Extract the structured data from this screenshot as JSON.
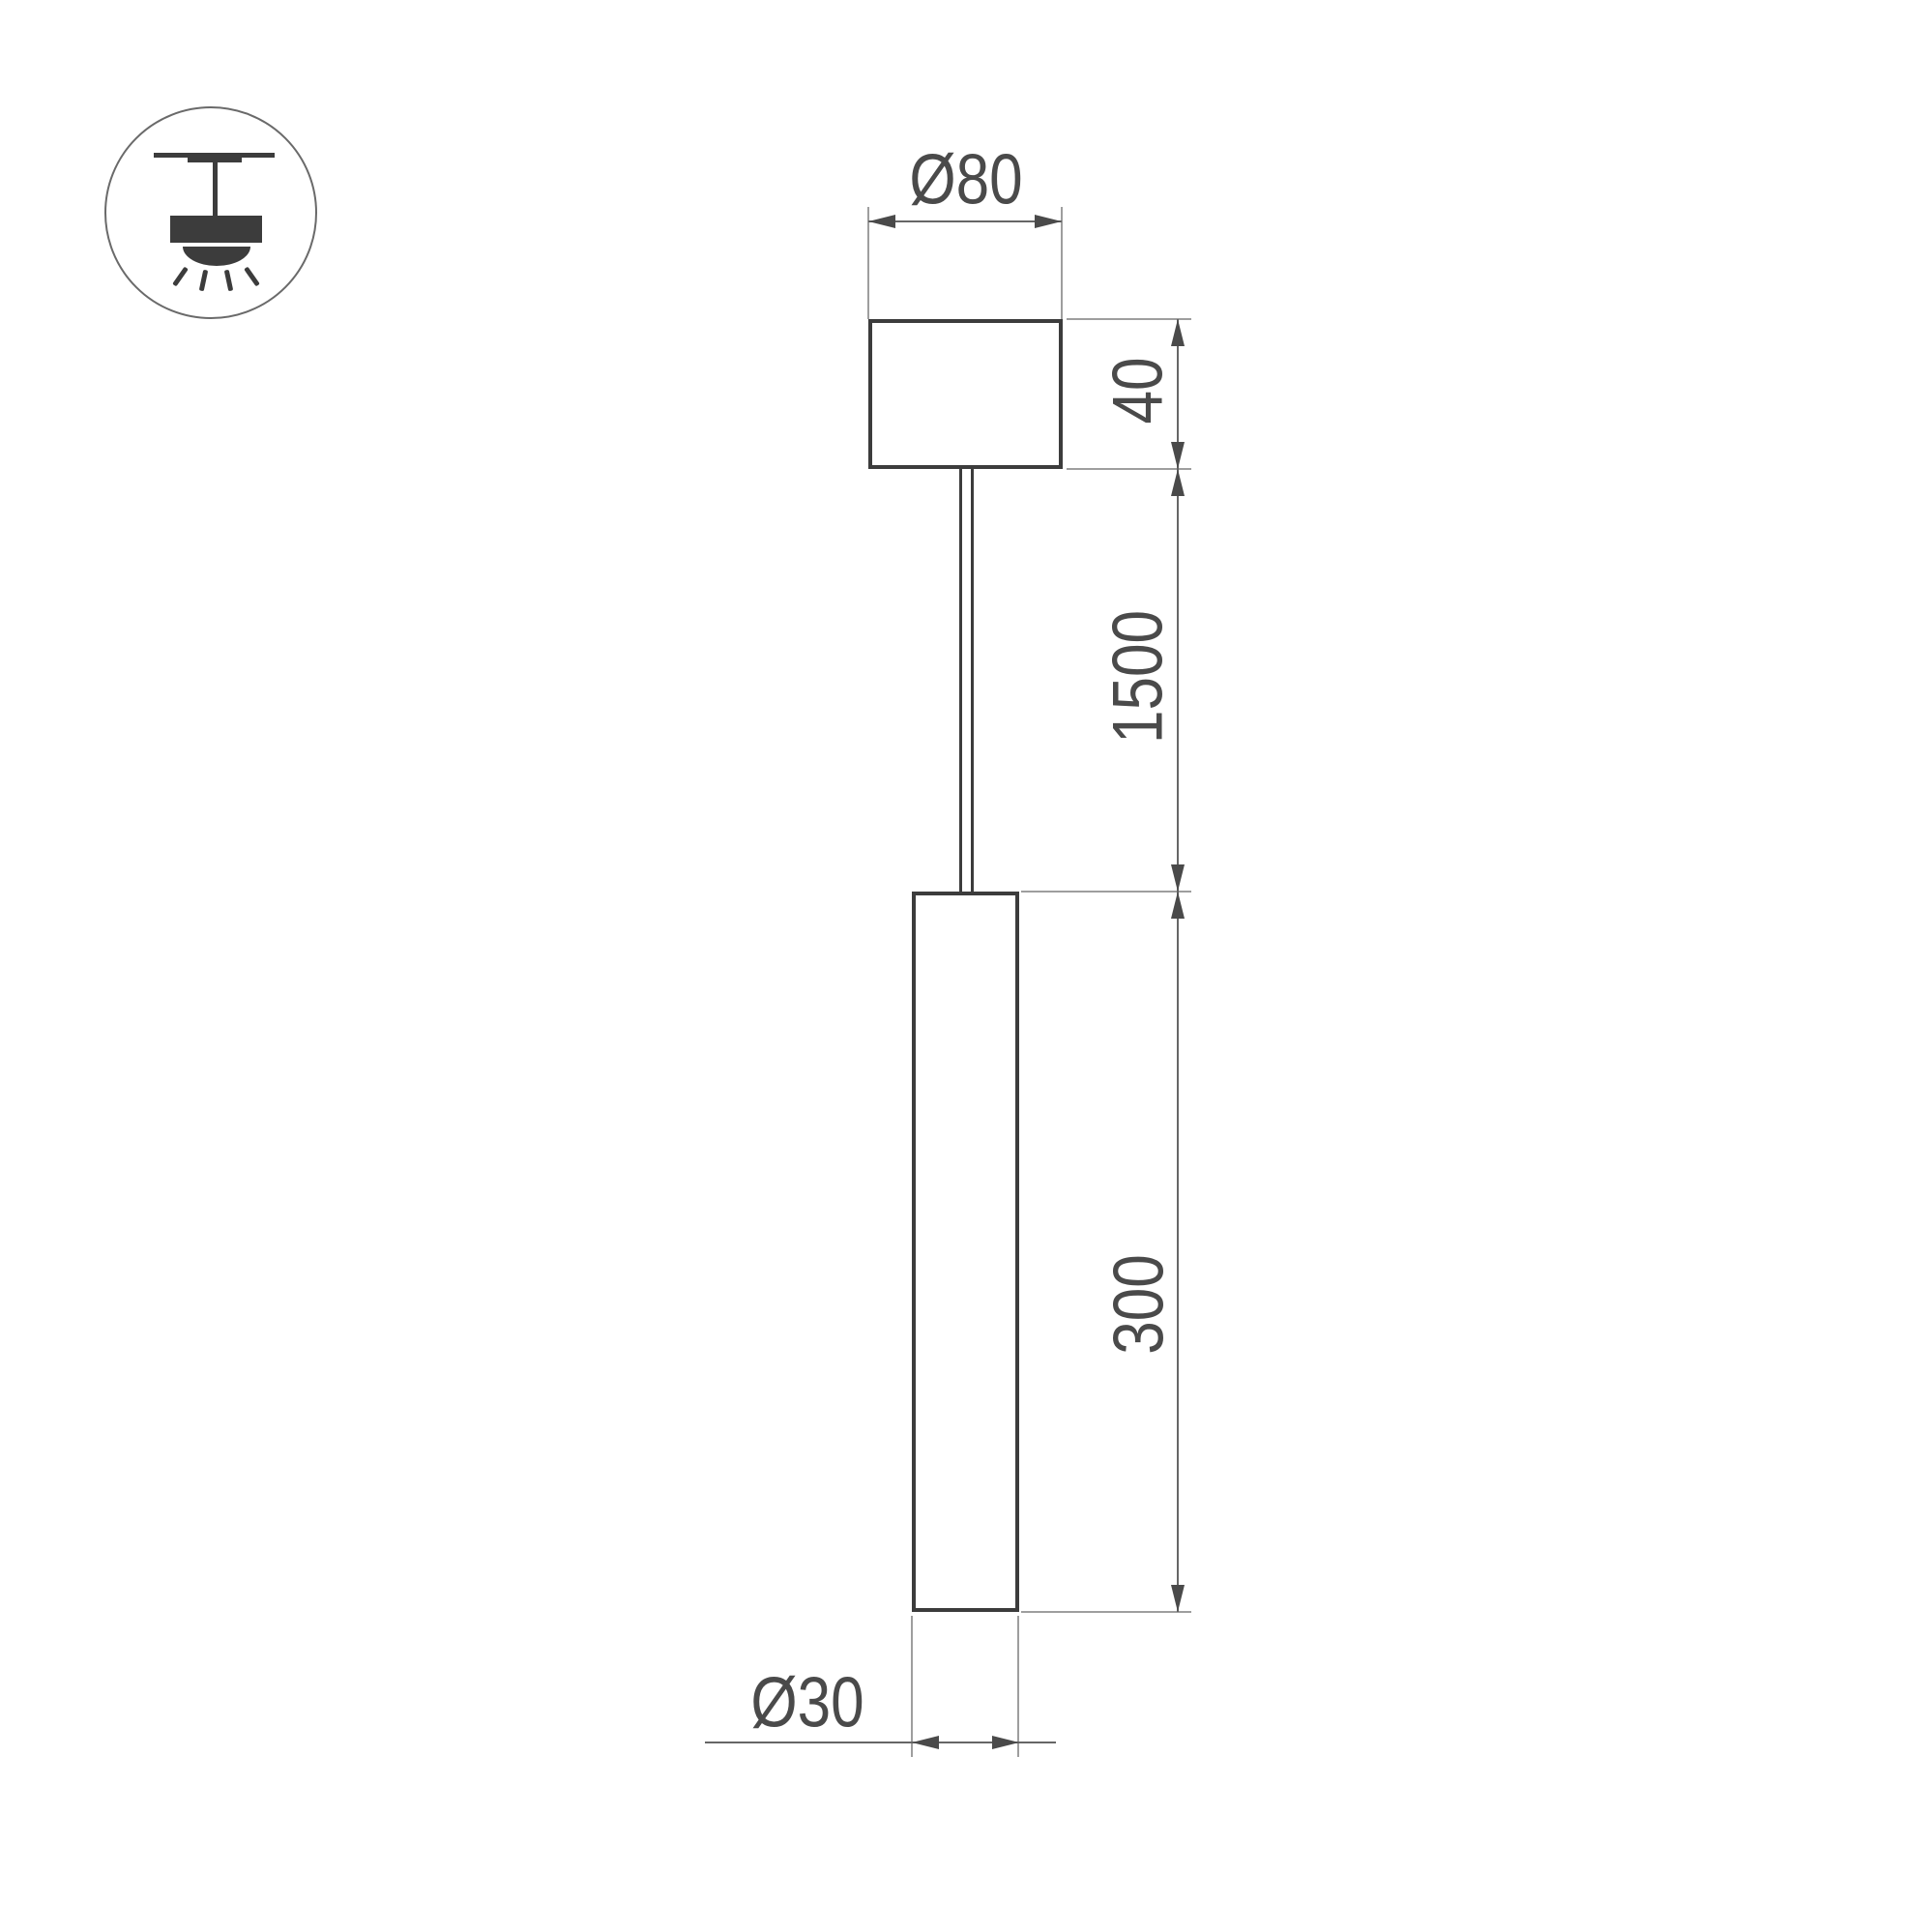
{
  "drawing": {
    "title": "pendant-lamp-dimension-drawing",
    "labels": {
      "canopy_diameter": "Ø80",
      "canopy_height": "40",
      "suspension_length": "1500",
      "tube_length": "300",
      "tube_diameter": "Ø30"
    },
    "icon": {
      "name": "pendant-ceiling-light-icon"
    },
    "colors": {
      "object_line": "#3c3c3c",
      "dimension_line": "#666666",
      "extension_line": "#9e9e9e",
      "text": "#4a4a4a",
      "background": "#ffffff"
    }
  }
}
